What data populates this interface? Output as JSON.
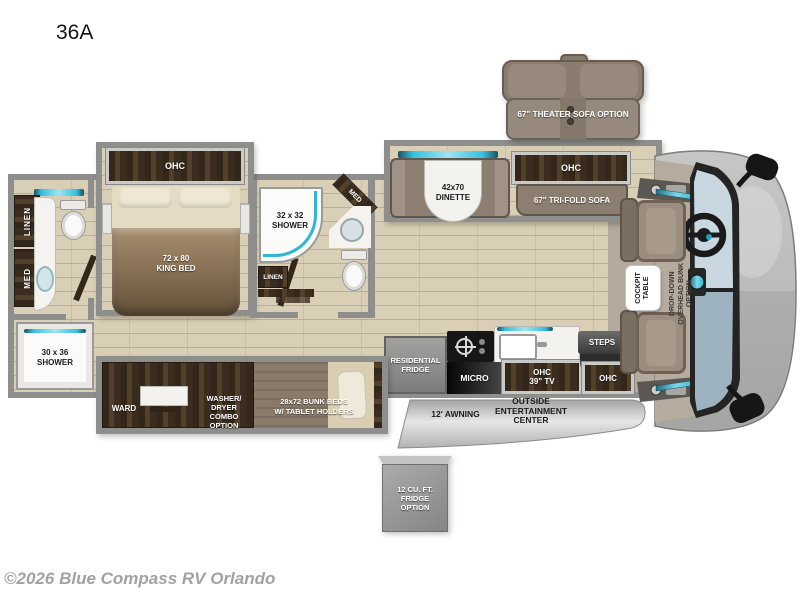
{
  "page": {
    "title": "36A",
    "copyright": "©2026 Blue Compass RV Orlando"
  },
  "colors": {
    "accent_teal": "#35c0de",
    "wood": "#3a2c1e",
    "taupe": "#8c7e70",
    "floor": "#d9cfb6",
    "wall": "#8e8e8c",
    "glass_upper": "#c9d8e0",
    "glass_lower": "#9db3bf"
  },
  "labels": {
    "bedroom": {
      "ohc": "OHC",
      "bed_size": "72 x 80",
      "bed_name": "KING BED"
    },
    "rear_bath": {
      "linen": "LINEN",
      "med": "MED",
      "shower_size": "30 x 36",
      "shower_name": "SHOWER"
    },
    "mid_bath": {
      "shower_size": "32 x 32",
      "shower_name": "SHOWER",
      "med": "MED",
      "linen": "LINEN"
    },
    "dinette": {
      "size": "42x70",
      "name": "DINETTE"
    },
    "sofa": {
      "ohc": "OHC",
      "trifold": "67\" TRI-FOLD SOFA"
    },
    "theater_sofa": {
      "option": "67\" THEATER SOFA OPTION"
    },
    "kitchen": {
      "fridge_l1": "RESIDENTIAL",
      "fridge_l2": "FRIDGE",
      "micro": "MICRO",
      "tv_l1": "OHC",
      "tv_l2": "39\" TV",
      "steps": "STEPS",
      "entry_ohc": "OHC"
    },
    "bunk_slide": {
      "ward": "WARD",
      "wd_l1": "WASHER/",
      "wd_l2": "DRYER",
      "wd_l3": "COMBO",
      "wd_l4": "OPTION",
      "bunk_l1": "28x72 BUNK BEDS",
      "bunk_l2": "W/ TABLET HOLDERS"
    },
    "cockpit": {
      "table_l1": "COCKPIT",
      "table_l2": "TABLE",
      "bunk_l1": "DROP-DOWN",
      "bunk_l2": "OVERHEAD BUNK",
      "bunk_l3": "OPTION"
    },
    "exterior": {
      "awning": "12' AWNING",
      "oec_l1": "OUTSIDE",
      "oec_l2": "ENTERTAINMENT",
      "oec_l3": "CENTER",
      "fridge_opt_l1": "12 CU. FT.",
      "fridge_opt_l2": "FRIDGE",
      "fridge_opt_l3": "OPTION"
    }
  }
}
